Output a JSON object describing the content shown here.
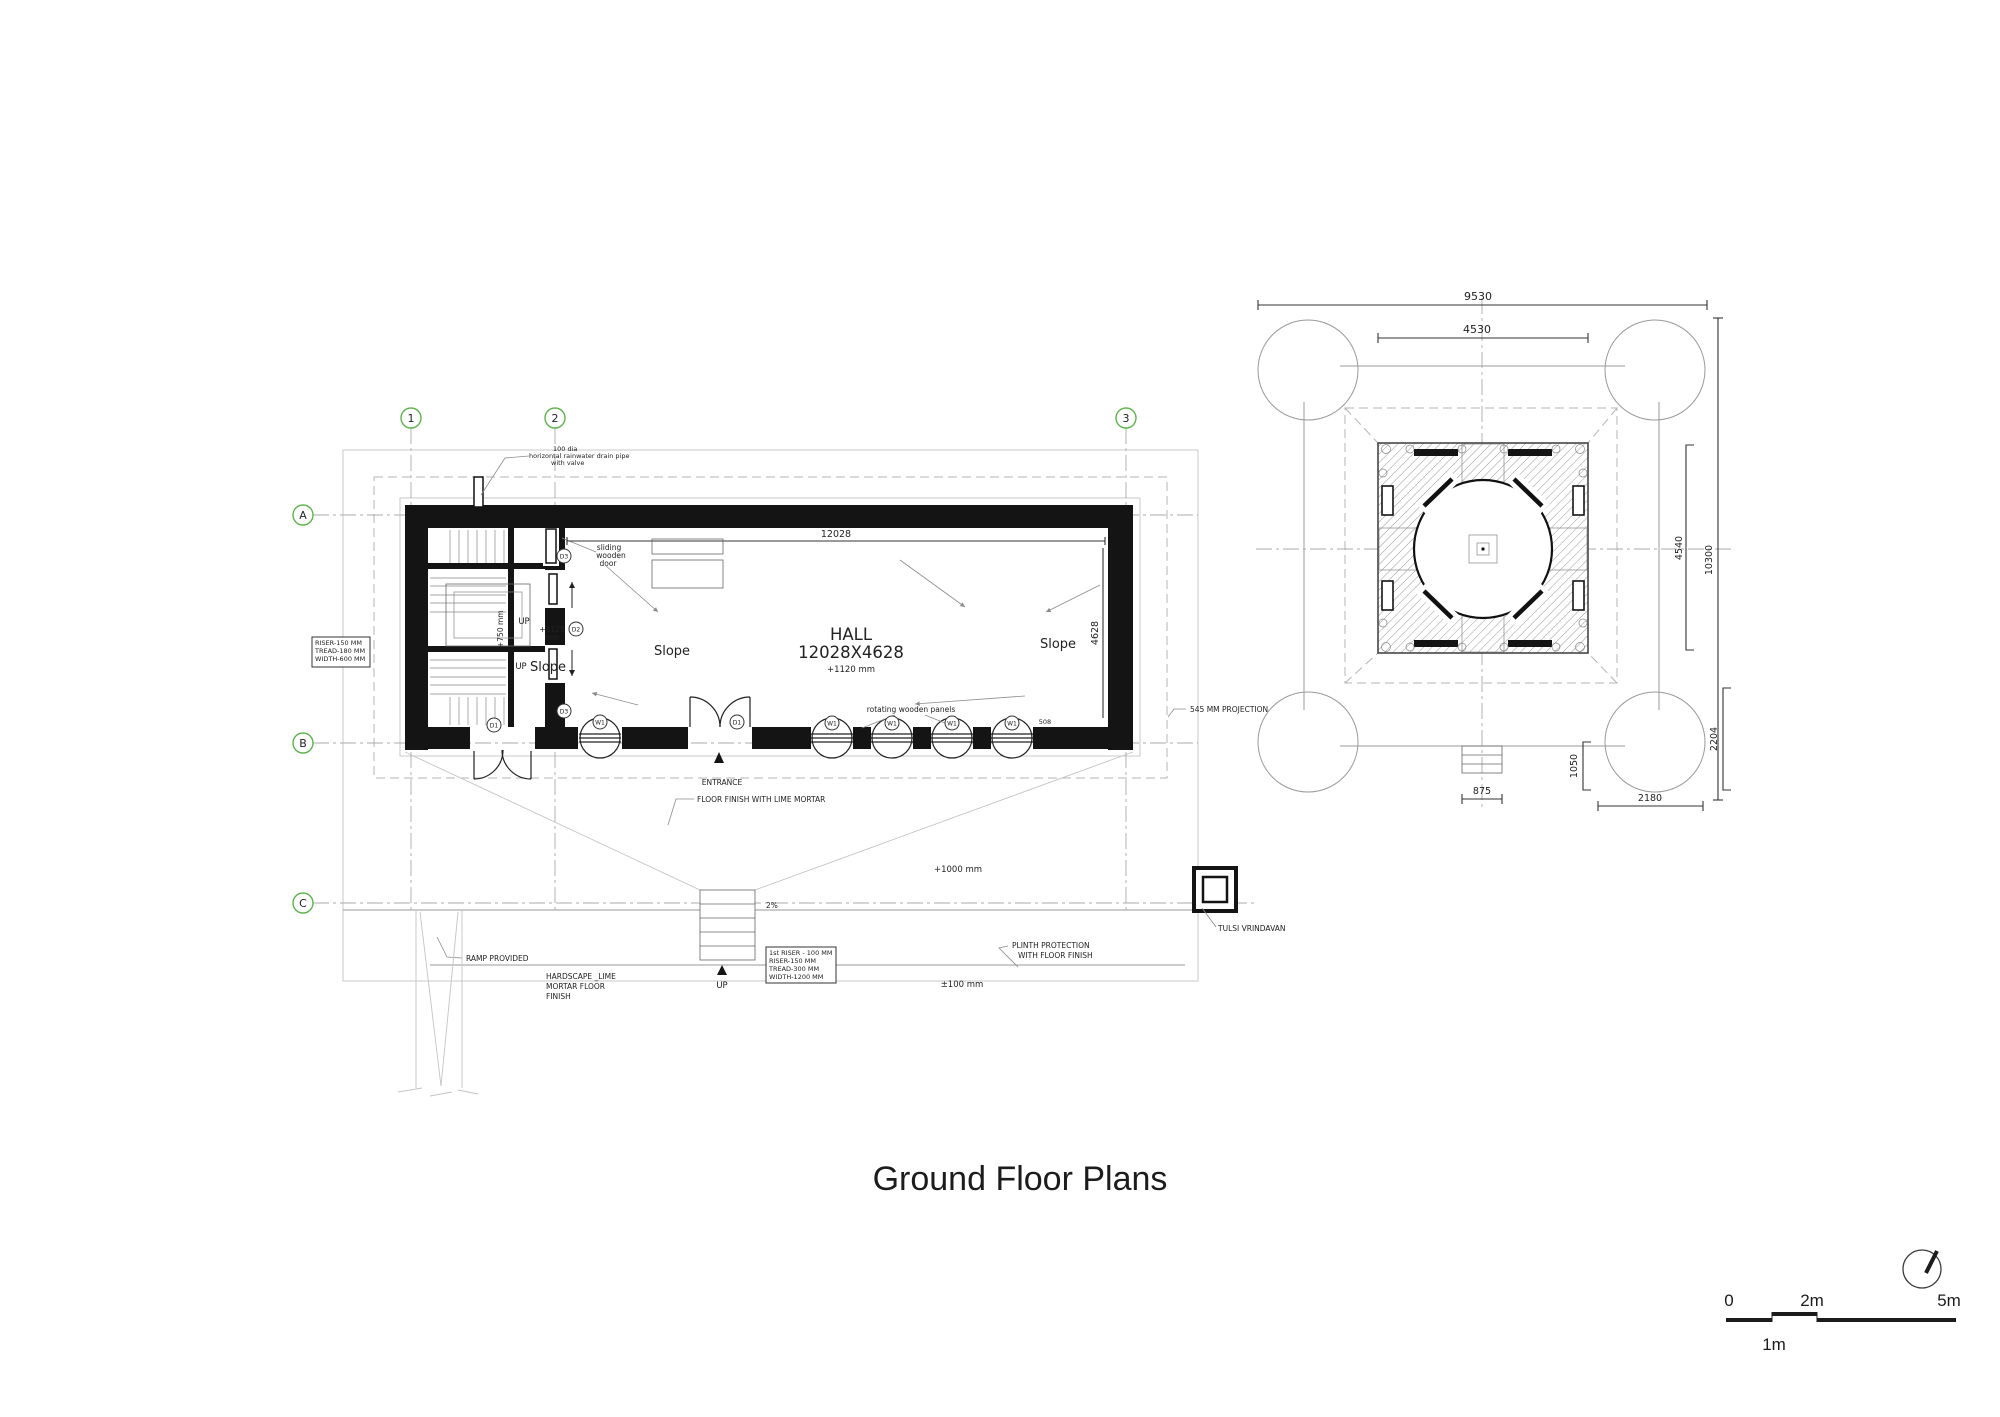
{
  "title": "Ground Floor Plans",
  "left": {
    "grid": {
      "cols": [
        "1",
        "2",
        "3"
      ],
      "rows": [
        "A",
        "B",
        "C"
      ]
    },
    "hall": {
      "name": "HALL",
      "size": "12028X4628",
      "level": "+1120 mm"
    },
    "dims": {
      "width": "12028",
      "depth": "4628",
      "panel": "508"
    },
    "slope": "Slope",
    "up": "UP",
    "entrance": "ENTRANCE",
    "levels": {
      "vestibule_l1": "+1125",
      "vestibule_l2": "mm",
      "stair_mid": "+750 mm",
      "apron": "+1000 mm",
      "ramp_pct": "2%",
      "ground": "±100 mm"
    },
    "tags": {
      "d1": "D1",
      "d2": "D2",
      "d3": "D3",
      "w1": "W1"
    },
    "notes": {
      "rain_pipe": [
        "100 dia",
        "horizontal rainwater drain pipe",
        "with valve"
      ],
      "sliding_door": [
        "sliding",
        "wooden",
        "door"
      ],
      "stair_spec": [
        "RISER-150 MM",
        "TREAD-180 MM",
        "WIDTH-600 MM"
      ],
      "rotating_panels": "rotating wooden panels",
      "projection": "545 MM PROJECTION",
      "floor_finish": "FLOOR FINISH WITH LIME MORTAR",
      "ramp": "RAMP PROVIDED",
      "hardscape": [
        "HARDSCAPE _LIME",
        "MORTAR FLOOR",
        "FINISH"
      ],
      "entry_stair_spec": [
        "1st RISER - 100 MM",
        "RISER-150 MM",
        "TREAD-300 MM",
        "WIDTH-1200 MM"
      ],
      "plinth": [
        "PLINTH PROTECTION",
        "WITH FLOOR FINISH"
      ],
      "tulsi": "TULSI VRINDAVAN"
    }
  },
  "right": {
    "dims": {
      "outer_w": "9530",
      "inner_w": "4530",
      "inner_h": "4540",
      "outer_h": "10300",
      "porch_w": "875",
      "corner_off": "1050",
      "corner_w": "2180",
      "corner_h": "2204"
    }
  },
  "scalebar": {
    "t0": "0",
    "t2": "2m",
    "t5": "5m",
    "t1": "1m"
  }
}
